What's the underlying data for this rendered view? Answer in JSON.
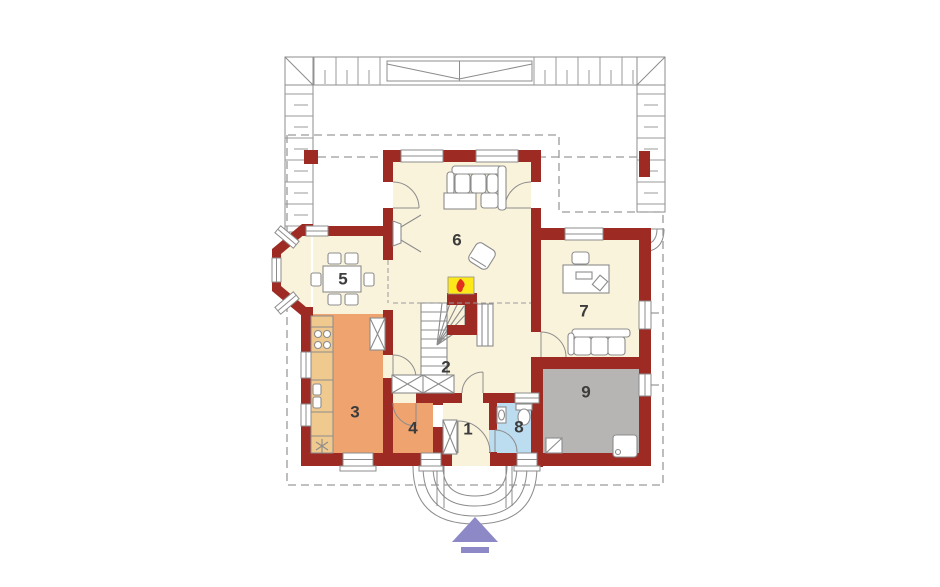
{
  "plan": {
    "kind": "house ground-floor plan",
    "rooms": [
      {
        "number": "1"
      },
      {
        "number": "2"
      },
      {
        "number": "3"
      },
      {
        "number": "4"
      },
      {
        "number": "5"
      },
      {
        "number": "6"
      },
      {
        "number": "7"
      },
      {
        "number": "8"
      },
      {
        "number": "9"
      }
    ]
  },
  "colors": {
    "wall": "#9d2b24",
    "floor": "#faf3dc",
    "kitchen": "#efa470",
    "counter": "#f0c98e",
    "bathroom": "#bcdcf0",
    "garage": "#b6b5b3",
    "fireplace": "#ffe81a",
    "flame": "#e03020",
    "arrow": "#8d89c6",
    "outline": "#8c8c8c",
    "dash": "#9a9a9a",
    "label": "#3c3c3c"
  }
}
